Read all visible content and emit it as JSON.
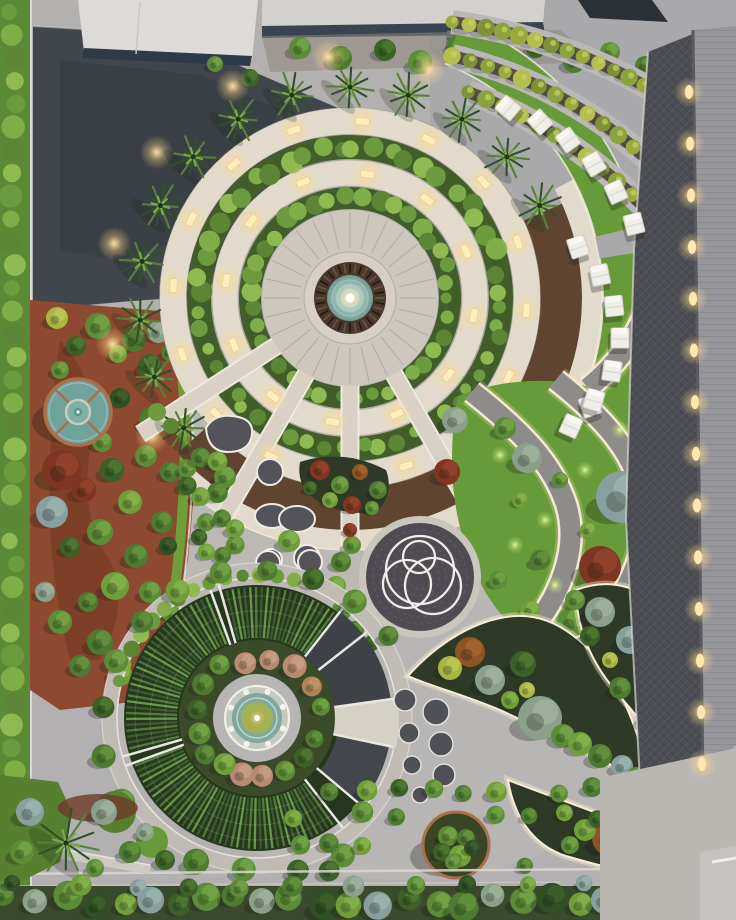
{
  "scene": {
    "type": "aerial-landscape-render",
    "description": "Dusk aerial view of a formal landscaped campus garden: concentric circular fountain garden with hedge rings and lit paths, terraced lawns with white sun loungers, dark lit promenade beside a building roof, ornamental crop circle garden, sculptural ring plaza, organic planting beds and tree rows",
    "width": 736,
    "height": 920
  },
  "palette": {
    "pavement": "#b3b1b0",
    "pavement_warm": "#c6c1b9",
    "pavement_cool": "#a9a8ab",
    "asphalt": "#41454c",
    "asphalt_dark": "#33373d",
    "path_cream": "#e2dbcb",
    "path_cream_lit": "#f6ecd4",
    "curb_white": "#edebe4",
    "walkway_dark": "#4b4d53",
    "roof_right": "#97969b",
    "roof_dark": "#2b3036",
    "roof_white": "#dcdbd7",
    "facade_dark": "#2e3a47",
    "lawn": "#679a38",
    "lawn_bright": "#79ac40",
    "lawn_dark": "#567f2f",
    "hedge_base": "#415e2a",
    "soil": "#5a5144",
    "soil_dark": "#2e3a26",
    "mulch": "#5f452f",
    "mulch_red": "#8e4a30",
    "crop_bg": "#26371e",
    "crop_row_a": "#3a5c2e",
    "crop_row_b": "#4f7c3c",
    "crop_row_c": "#66984a",
    "sector_dark": "#3e4247",
    "pond_water": "#6fa39c",
    "pond_copper": "#a8714a",
    "fountain_bronze": "#4a372b",
    "fountain_teal": "#8fb3aa",
    "pad_dark": "#55535a",
    "plaza_dark": "#4e4b52",
    "paver_gray": "#8e8c89",
    "light_warm": "#ffeebb",
    "hedge_bumps": [
      "#6c9a3e",
      "#7fae49",
      "#5c8636",
      "#8fba52"
    ],
    "terrace_hedge": [
      "#9aa83e",
      "#b4bf4f",
      "#7f9136",
      "#8aa33f"
    ]
  },
  "tree_types": {
    "g0": [
      "#4e7a31",
      "#6f9c44"
    ],
    "g1": [
      "#5d8c38",
      "#7fae4e"
    ],
    "g2": [
      "#3c6128",
      "#578436"
    ],
    "g3": [
      "#6f9e3a",
      "#8fbc52"
    ],
    "sage": [
      "#8ba08a",
      "#a8bba4"
    ],
    "sageb": [
      "#87a09e",
      "#a5bcb8"
    ],
    "red": [
      "#7e3522",
      "#9c4a2e"
    ],
    "rust": [
      "#8f5426",
      "#b06c34"
    ],
    "yg": [
      "#a9b544",
      "#c6cf5c"
    ],
    "tan": [
      "#b08257",
      "#c89c70"
    ],
    "pink": [
      "#b98a72",
      "#d0a78c"
    ],
    "dk": [
      "#2f4f24",
      "#44672f"
    ]
  },
  "big_circle": {
    "cx": 350,
    "cy": 298,
    "plaza_r": 88,
    "hedge_rings": [
      {
        "r": 100,
        "w": 22,
        "count": 38
      },
      {
        "r": 151,
        "w": 24,
        "count": 52
      }
    ],
    "path_rings": [
      {
        "r": 125,
        "w": 26,
        "lights": 12
      },
      {
        "r": 177,
        "w": 27,
        "lights": 16
      }
    ],
    "mulch_arc": {
      "r": 211,
      "w": 42,
      "a0": 138,
      "a1": -24
    },
    "outer_arc": {
      "r": 242,
      "w": 20,
      "a0": 132,
      "a1": -28,
      "lights": 7
    },
    "palm_angles": [
      142,
      158,
      174,
      190,
      206,
      222,
      238,
      254,
      270,
      286,
      302,
      318,
      334
    ],
    "spoke_angles": [
      60,
      90,
      120,
      147
    ],
    "inner_bump_angles": [
      200,
      220,
      240,
      260,
      280,
      300,
      320,
      340,
      355
    ]
  },
  "loungers": [
    [
      508,
      108,
      -50
    ],
    [
      540,
      122,
      -43
    ],
    [
      568,
      140,
      -36
    ],
    [
      594,
      164,
      -30
    ],
    [
      616,
      192,
      -24
    ],
    [
      634,
      224,
      -14
    ],
    [
      578,
      247,
      -18
    ],
    [
      600,
      275,
      -12
    ],
    [
      614,
      306,
      -6
    ],
    [
      620,
      338,
      0
    ],
    [
      612,
      371,
      8
    ],
    [
      594,
      400,
      16
    ],
    [
      571,
      426,
      24
    ]
  ],
  "terrace_hedge_rows": [
    {
      "p0": [
        452,
        22
      ],
      "p1": [
        580,
        40
      ],
      "p2": [
        688,
        112
      ],
      "n": 16
    },
    {
      "p0": [
        452,
        56
      ],
      "p1": [
        588,
        88
      ],
      "p2": [
        690,
        202
      ],
      "n": 16
    },
    {
      "p0": [
        468,
        92
      ],
      "p1": [
        596,
        140
      ],
      "p2": [
        686,
        255
      ],
      "n": 15
    }
  ],
  "regions": {
    "gravel_shrubs": [
      [
        300,
        48,
        11,
        "g1"
      ],
      [
        340,
        58,
        12,
        "g0"
      ],
      [
        385,
        50,
        11,
        "g2"
      ],
      [
        420,
        62,
        12,
        "g1"
      ],
      [
        458,
        46,
        11,
        "g0"
      ],
      [
        498,
        58,
        12,
        "g1"
      ],
      [
        536,
        48,
        10,
        "g2"
      ],
      [
        574,
        62,
        11,
        "g0"
      ],
      [
        610,
        52,
        10,
        "g1"
      ],
      [
        645,
        66,
        10,
        "g0"
      ],
      [
        250,
        78,
        9,
        "g2"
      ],
      [
        215,
        64,
        8,
        "g1"
      ]
    ],
    "left_garden_trees": [
      [
        57,
        318,
        11,
        "yg"
      ],
      [
        98,
        326,
        13,
        "g1"
      ],
      [
        134,
        340,
        12,
        "g0"
      ],
      [
        76,
        346,
        10,
        "g2"
      ],
      [
        118,
        354,
        9,
        "g3"
      ],
      [
        158,
        332,
        11,
        "sage"
      ],
      [
        170,
        352,
        9,
        "g0"
      ],
      [
        60,
        370,
        9,
        "g1"
      ],
      [
        150,
        366,
        12,
        "g2"
      ],
      [
        120,
        398,
        10,
        "dk"
      ],
      [
        152,
        420,
        13,
        "g0"
      ],
      [
        102,
        442,
        10,
        "g1"
      ],
      [
        62,
        470,
        20,
        "red"
      ],
      [
        84,
        490,
        12,
        "red"
      ],
      [
        52,
        512,
        16,
        "sageb"
      ],
      [
        112,
        470,
        12,
        "g2"
      ],
      [
        146,
        456,
        11,
        "g1"
      ],
      [
        170,
        472,
        10,
        "g0"
      ],
      [
        130,
        502,
        12,
        "g3"
      ],
      [
        162,
        522,
        11,
        "g0"
      ],
      [
        100,
        532,
        13,
        "g1"
      ],
      [
        70,
        547,
        10,
        "g2"
      ],
      [
        136,
        556,
        12,
        "g0"
      ],
      [
        168,
        546,
        9,
        "dk"
      ],
      [
        115,
        586,
        14,
        "g3"
      ],
      [
        150,
        592,
        11,
        "g1"
      ],
      [
        88,
        602,
        10,
        "g0"
      ],
      [
        45,
        592,
        10,
        "sage"
      ],
      [
        60,
        622,
        12,
        "g1"
      ],
      [
        100,
        642,
        13,
        "g0"
      ],
      [
        140,
        627,
        10,
        "g2"
      ],
      [
        170,
        612,
        9,
        "g1"
      ],
      [
        80,
        666,
        11,
        "g0"
      ],
      [
        120,
        674,
        12,
        "g3"
      ],
      [
        155,
        662,
        10,
        "g1"
      ]
    ],
    "s_garden_trees": [
      [
        455,
        420,
        13,
        "sage"
      ],
      [
        527,
        458,
        15,
        "sage"
      ],
      [
        622,
        497,
        26,
        "sageb"
      ],
      [
        662,
        437,
        17,
        "sage"
      ],
      [
        600,
        567,
        21,
        "red"
      ],
      [
        447,
        472,
        13,
        "red"
      ],
      [
        505,
        428,
        11,
        "g1"
      ],
      [
        540,
        560,
        10,
        "g0"
      ],
      [
        572,
        622,
        15,
        "g1"
      ],
      [
        612,
        664,
        13,
        "g0"
      ],
      [
        648,
        610,
        11,
        "g2"
      ],
      [
        530,
        610,
        10,
        "g3"
      ],
      [
        498,
        580,
        9,
        "g1"
      ],
      [
        520,
        500,
        8,
        "g3"
      ],
      [
        560,
        480,
        8,
        "g1"
      ],
      [
        588,
        530,
        8,
        "g3"
      ],
      [
        640,
        580,
        8,
        "g1"
      ],
      [
        680,
        555,
        9,
        "g0"
      ]
    ],
    "s_garden_glows": [
      [
        500,
        455
      ],
      [
        515,
        545
      ],
      [
        555,
        585
      ],
      [
        600,
        620
      ],
      [
        640,
        545
      ],
      [
        660,
        480
      ],
      [
        620,
        430
      ],
      [
        585,
        470
      ],
      [
        545,
        520
      ],
      [
        630,
        665
      ],
      [
        590,
        680
      ]
    ],
    "nw_bed_plants": [
      [
        320,
        470,
        10,
        "red"
      ],
      [
        340,
        485,
        9,
        "g1"
      ],
      [
        360,
        472,
        8,
        "rust"
      ],
      [
        378,
        490,
        9,
        "g0"
      ],
      [
        330,
        500,
        8,
        "g3"
      ],
      [
        352,
        505,
        9,
        "red"
      ],
      [
        372,
        508,
        7,
        "g1"
      ],
      [
        310,
        488,
        7,
        "g2"
      ]
    ],
    "plaza_crescent_plants": [
      [
        352,
        545,
        9,
        "g1"
      ],
      [
        341,
        562,
        10,
        "g0"
      ],
      [
        336,
        586,
        10,
        "g3"
      ],
      [
        342,
        610,
        10,
        "g1"
      ],
      [
        355,
        630,
        9,
        "g0"
      ],
      [
        372,
        643,
        8,
        "g2"
      ],
      [
        350,
        530,
        7,
        "red"
      ]
    ],
    "bed_a_trees": [
      [
        470,
        652,
        15,
        "rust"
      ],
      [
        450,
        668,
        12,
        "yg"
      ],
      [
        490,
        680,
        15,
        "sage"
      ],
      [
        523,
        664,
        13,
        "g2"
      ],
      [
        540,
        718,
        22,
        "sage"
      ],
      [
        563,
        736,
        12,
        "g1"
      ],
      [
        580,
        744,
        12,
        "g3"
      ],
      [
        600,
        756,
        12,
        "g0"
      ],
      [
        622,
        766,
        11,
        "sageb"
      ],
      [
        510,
        700,
        9,
        "g3"
      ],
      [
        527,
        690,
        8,
        "yg"
      ],
      [
        636,
        776,
        9,
        "g1"
      ]
    ],
    "bed_b_trees": [
      [
        600,
        612,
        15,
        "sage"
      ],
      [
        575,
        600,
        10,
        "g1"
      ],
      [
        630,
        640,
        14,
        "sageb"
      ],
      [
        655,
        672,
        13,
        "sage"
      ],
      [
        590,
        636,
        10,
        "g2"
      ],
      [
        620,
        688,
        11,
        "g0"
      ],
      [
        648,
        720,
        11,
        "g1"
      ],
      [
        668,
        746,
        11,
        "sage"
      ],
      [
        610,
        660,
        8,
        "yg"
      ],
      [
        680,
        710,
        9,
        "g2"
      ]
    ],
    "bed_c_trees": [
      [
        610,
        838,
        18,
        "rust"
      ],
      [
        644,
        848,
        17,
        "rust"
      ],
      [
        585,
        830,
        11,
        "g3"
      ],
      [
        630,
        820,
        10,
        "g0"
      ],
      [
        668,
        862,
        12,
        "g1"
      ],
      [
        700,
        868,
        12,
        "sage"
      ],
      [
        570,
        845,
        9,
        "g1"
      ],
      [
        690,
        840,
        9,
        "g2"
      ]
    ],
    "bottom_left_trees": [
      [
        30,
        812,
        14,
        "sageb"
      ],
      [
        104,
        812,
        13,
        "sage"
      ],
      [
        22,
        852,
        12,
        "g1"
      ],
      [
        130,
        852,
        11,
        "g0"
      ],
      [
        165,
        860,
        10,
        "g2"
      ],
      [
        95,
        868,
        9,
        "g1"
      ],
      [
        145,
        832,
        9,
        "sage"
      ]
    ]
  },
  "pads": {
    "bean": {
      "cx": 228,
      "cy": 435
    },
    "circles": [
      [
        270,
        472,
        13
      ],
      [
        271,
        560,
        11
      ],
      [
        307,
        558,
        13
      ],
      [
        268,
        563,
        12
      ],
      [
        310,
        562,
        12
      ]
    ],
    "double_blob": [
      [
        272,
        516,
        17,
        12
      ],
      [
        297,
        519,
        18,
        13
      ]
    ],
    "clusters": [
      {
        "cx": 205,
        "cy": 477,
        "ring": 20,
        "balls": 7,
        "ball_r": 11
      },
      {
        "cx": 218,
        "cy": 537,
        "ring": 19,
        "balls": 7,
        "ball_r": 10
      }
    ],
    "mound": [
      289,
      541,
      11
    ]
  },
  "pad_dots": [
    [
      405,
      700,
      11
    ],
    [
      436,
      712,
      13
    ],
    [
      409,
      733,
      10
    ],
    [
      441,
      744,
      12
    ],
    [
      412,
      765,
      9
    ],
    [
      444,
      775,
      11
    ],
    [
      420,
      795,
      8
    ]
  ],
  "plaza": {
    "cx": 420,
    "cy": 577,
    "r": 54,
    "rings": [
      [
        420,
        570,
        34
      ],
      [
        407,
        584,
        24
      ],
      [
        433,
        586,
        28
      ],
      [
        419,
        557,
        16
      ]
    ]
  },
  "pond": {
    "cx": 78,
    "cy": 412,
    "r": 33
  },
  "planter": {
    "cx": 456,
    "cy": 845,
    "r": 33,
    "balls": [
      [
        448,
        836,
        10,
        "g1"
      ],
      [
        466,
        838,
        9,
        "g0"
      ],
      [
        442,
        852,
        9,
        "g2"
      ],
      [
        460,
        856,
        11,
        "g3"
      ],
      [
        472,
        848,
        8,
        "dk"
      ],
      [
        453,
        862,
        8,
        "g1"
      ]
    ]
  },
  "crop_garden": {
    "cx": 257,
    "cy": 718,
    "sectors": [
      [
        52,
        160
      ],
      [
        164,
        250
      ],
      [
        254,
        322
      ]
    ],
    "dark_sectors": [
      [
        -52,
        -8
      ],
      [
        12,
        40
      ]
    ],
    "spokes": [
      -52,
      -8,
      12,
      40,
      52,
      160,
      164,
      250,
      254,
      322
    ],
    "mid_ring_r": 61,
    "mid_trees": [
      [
        258,
        11,
        "pink"
      ],
      [
        282,
        10,
        "pink"
      ],
      [
        306,
        12,
        "pink"
      ],
      [
        330,
        10,
        "tan"
      ],
      [
        350,
        9,
        "g1"
      ],
      [
        20,
        9,
        "g0"
      ],
      [
        40,
        10,
        "g2"
      ],
      [
        62,
        10,
        "g1"
      ],
      [
        85,
        11,
        "pink"
      ],
      [
        105,
        12,
        "pink"
      ],
      [
        125,
        11,
        "g3"
      ],
      [
        145,
        10,
        "g0"
      ],
      [
        165,
        11,
        "g1"
      ],
      [
        188,
        10,
        "g2"
      ],
      [
        212,
        11,
        "g0"
      ],
      [
        235,
        10,
        "g1"
      ]
    ],
    "rim_hedge": {
      "r": 143,
      "a0": 195,
      "a1": 285,
      "n": 14
    },
    "fringe_trees": [
      [
        95,
        152,
        12,
        "g1"
      ],
      [
        113,
        156,
        13,
        "g0"
      ],
      [
        130,
        158,
        12,
        "g3"
      ],
      [
        148,
        160,
        14,
        "g1"
      ],
      [
        166,
        158,
        12,
        "g0"
      ],
      [
        184,
        154,
        11,
        "g2"
      ],
      [
        202,
        152,
        12,
        "g1"
      ],
      [
        220,
        150,
        11,
        "g0"
      ],
      [
        238,
        150,
        12,
        "g3"
      ],
      [
        256,
        150,
        11,
        "g1"
      ],
      [
        274,
        148,
        10,
        "g0"
      ],
      [
        292,
        150,
        11,
        "g2"
      ],
      [
        310,
        152,
        12,
        "g1"
      ],
      [
        328,
        155,
        10,
        "g0"
      ],
      [
        75,
        158,
        11,
        "g2"
      ],
      [
        58,
        162,
        12,
        "g1"
      ]
    ]
  },
  "walkway": {
    "lights": 14
  },
  "bottom_row": {
    "count": 26,
    "types": [
      "g0",
      "sage",
      "g1",
      "dk",
      "g3",
      "sageb",
      "g2",
      "g1"
    ]
  },
  "shrub_grid": {
    "x0": 298,
    "y0": 790,
    "dx": 33,
    "dy": 26,
    "cols": 10,
    "rows": 4
  }
}
